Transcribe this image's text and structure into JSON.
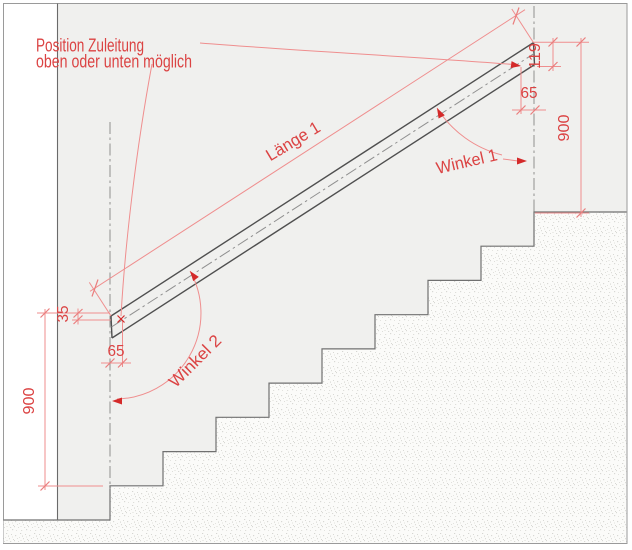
{
  "note": {
    "line1": "Position Zuleitung",
    "line2": "oben oder unten möglich"
  },
  "labels": {
    "length1": "Länge 1",
    "angle1": "Winkel 1",
    "angle2": "Winkel 2"
  },
  "dimensions": {
    "height_left": "900",
    "height_right": "900",
    "end_offset_top": "65",
    "end_offset_bottom": "65",
    "rail_end_height": "119",
    "rail_top_offset": "35"
  },
  "colors": {
    "drawing_background": "#f0f0ee",
    "paper": "#ffffff",
    "stair_outline": "#707070",
    "stipple_dot": "#d8d8d4",
    "rail_line": "#4f4f4f",
    "center_axis": "#8f8f8f",
    "dimension_line": "#ef8e8e",
    "dimension_text": "#db4343",
    "arrowhead": "#d42a2a",
    "border": "#9a9a9a"
  }
}
